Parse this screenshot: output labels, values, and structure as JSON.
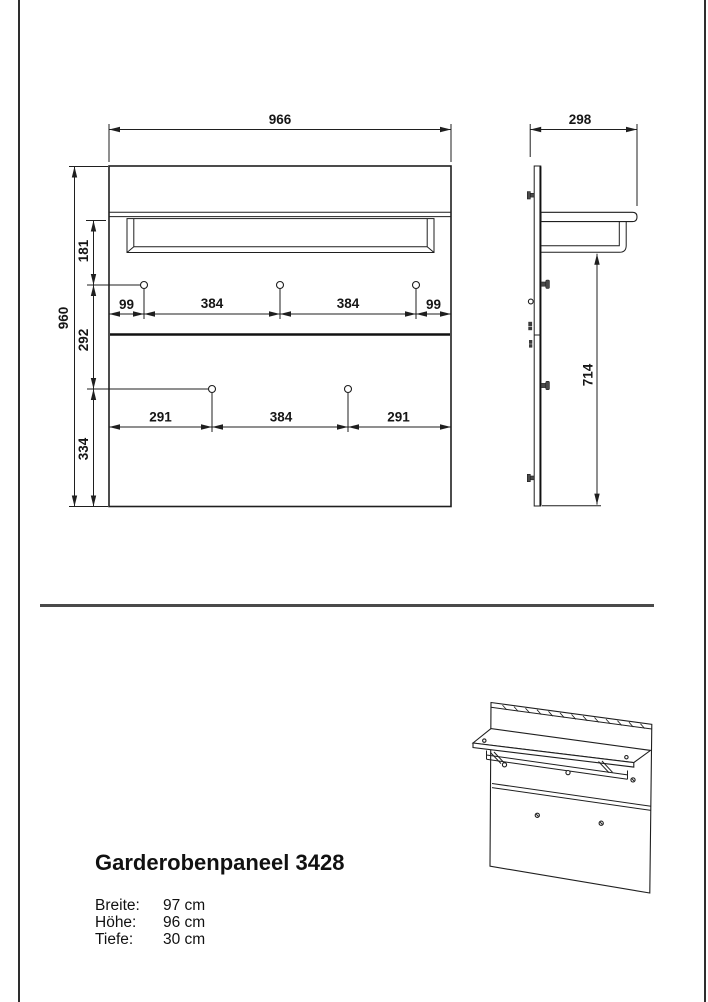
{
  "page": {
    "background": "#ffffff",
    "border_color": "#2e2e2e",
    "line_color": "#1f1f1f",
    "divider_color": "#4a4a4a"
  },
  "front_view": {
    "width": "966",
    "height": "960",
    "left_chain": [
      "181",
      "292",
      "334"
    ],
    "top_hook_dims": [
      "99",
      "384",
      "384",
      "99"
    ],
    "bottom_hook_dims": [
      "291",
      "384",
      "291"
    ]
  },
  "side_view": {
    "depth": "298",
    "rail_height": "714"
  },
  "product": {
    "title": "Garderobenpaneel 3428",
    "specs": [
      {
        "label": "Breite:",
        "value": "97 cm"
      },
      {
        "label": "Höhe:",
        "value": "96 cm"
      },
      {
        "label": "Tiefe:",
        "value": "30 cm"
      }
    ]
  }
}
